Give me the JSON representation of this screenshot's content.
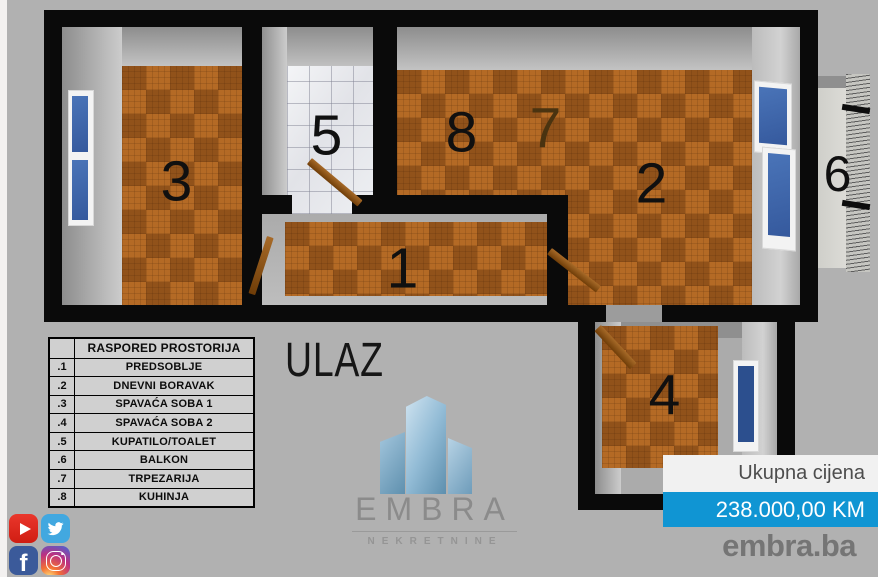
{
  "floorplan": {
    "entrance_label": "ULAZ",
    "room_labels": [
      "1",
      "2",
      "3",
      "4",
      "5",
      "6",
      "7",
      "8"
    ]
  },
  "legend": {
    "title": "RASPORED PROSTORIJA",
    "rows": [
      {
        "num": ".1",
        "name": "PREDSOBLJE"
      },
      {
        "num": ".2",
        "name": "DNEVNI BORAVAK"
      },
      {
        "num": ".3",
        "name": "SPAVAĆA SOBA 1"
      },
      {
        "num": ".4",
        "name": "SPAVAĆA SOBA 2"
      },
      {
        "num": ".5",
        "name": "KUPATILO/TOALET"
      },
      {
        "num": ".6",
        "name": "BALKON"
      },
      {
        "num": ".7",
        "name": "TRPEZARIJA"
      },
      {
        "num": ".8",
        "name": "KUHINJA"
      }
    ]
  },
  "logo": {
    "brand": "EMBRA",
    "subtitle": "NEKRETNINE"
  },
  "price": {
    "label": "Ukupna cijena",
    "value": "238.000,00 KM",
    "accent_color": "#1095d3"
  },
  "website": "embra.ba",
  "social": {
    "icons": [
      "youtube",
      "twitter",
      "facebook",
      "instagram"
    ]
  },
  "colors": {
    "background": "#b1b1b1",
    "walls": "#0a0a0a",
    "wood_floor": "#a9611f",
    "bathroom_tile": "#e8e9ec",
    "price_accent": "#1095d3"
  }
}
